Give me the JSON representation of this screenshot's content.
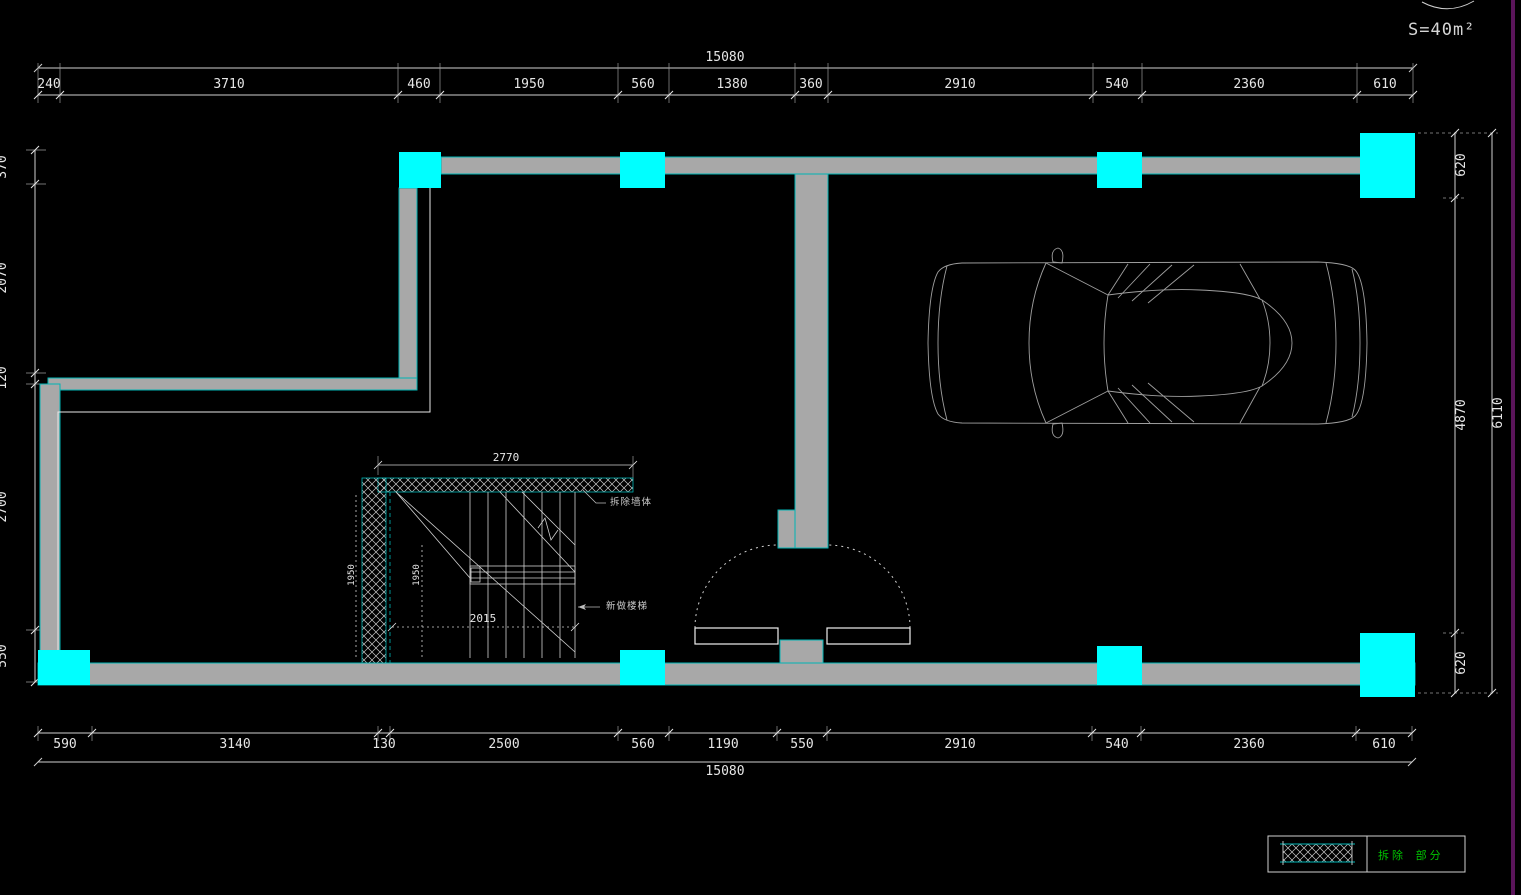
{
  "drawing": {
    "title": "basement garage floor plan",
    "area_label": "S=40m²",
    "dims": {
      "top_total": "15080",
      "top_chain": [
        "240",
        "3710",
        "460",
        "1950",
        "560",
        "1380",
        "360",
        "2910",
        "540",
        "2360",
        "610"
      ],
      "bottom_chain": [
        "590",
        "3140",
        "130",
        "2500",
        "560",
        "1190",
        "550",
        "2910",
        "540",
        "2360",
        "610"
      ],
      "bottom_total": "15080",
      "left_chain": [
        "370",
        "2070",
        "120",
        "2700",
        "550"
      ],
      "right_chain": [
        "620",
        "4870",
        "620"
      ],
      "right_total": "6110"
    },
    "stair": {
      "width_dim": "2770",
      "depth_dim_a": "1950",
      "depth_dim_b": "1950",
      "run_dim": "2015",
      "label_demolish_wall": "拆除墙体",
      "label_new_stair": "新做楼梯"
    },
    "legend": {
      "hatch_label": "拆除 部分"
    },
    "colors": {
      "background": "#000000",
      "wall_fill": "#a8a8a8",
      "wall_edge": "#00b4b4",
      "column_fill": "#00ffff",
      "dim_line": "#cfcfcf",
      "dim_text": "#e6e6e6",
      "legend_text": "#00c400",
      "viewport_edge": "#5a155a",
      "car_line": "#9f9f9f"
    }
  }
}
